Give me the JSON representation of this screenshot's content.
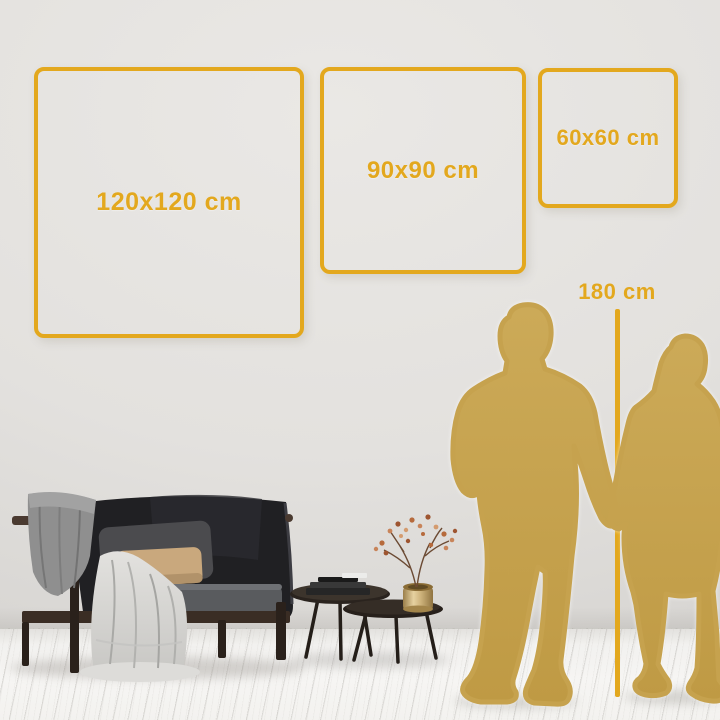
{
  "size_guide": {
    "sizes": [
      {
        "id": "size-120",
        "label": "120x120 cm"
      },
      {
        "id": "size-90",
        "label": "90x90 cm"
      },
      {
        "id": "size-60",
        "label": "60x60 cm"
      }
    ],
    "height_reference": {
      "label": "180 cm"
    }
  },
  "palette": {
    "accent_gold": "#e3a81e",
    "silhouette_gold": "#c6a24e",
    "wall_gray": "#e2e0dd",
    "floor_white": "#f4f3f1",
    "sofa_charcoal": "#1f1f22",
    "pillow_tan": "#c9a87d",
    "throw_light": "#d6d5d2",
    "throw_gray": "#8f8f8f",
    "table_wood": "#39312a",
    "vase_brass": "#c9b078"
  }
}
